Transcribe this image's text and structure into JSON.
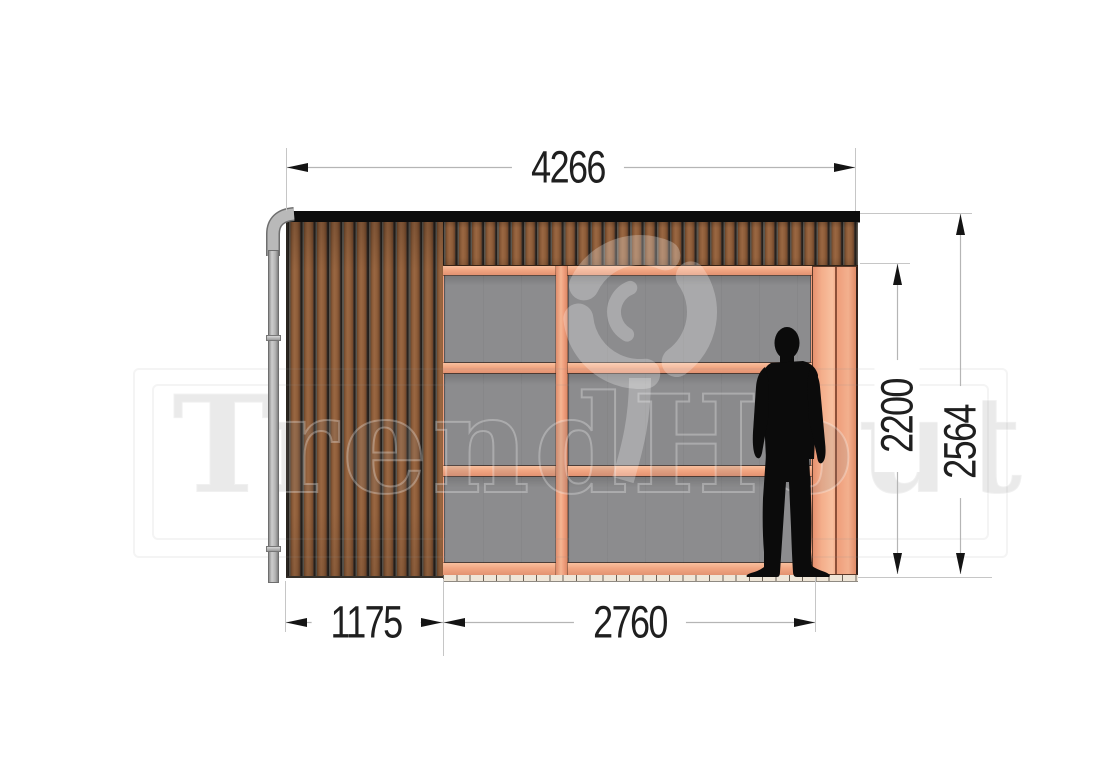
{
  "drawing": {
    "type": "garden-building-front-elevation",
    "dimensions": {
      "total_width_mm": "4266",
      "total_height_mm": "2564",
      "opening_height_mm": "2200",
      "left_section_width_mm": "1175",
      "opening_width_mm": "2760"
    },
    "watermark": {
      "brand": "TrendHout"
    },
    "colors": {
      "frame_wood": "#f0a17e",
      "cladding_wood": "#8a5a37",
      "glass": "#8c8c8e",
      "roof_edge": "#0c0c0c",
      "downpipe": "#b9b9b9",
      "dimension_text": "#1f1f1f",
      "dimension_line": "#b9b9b9"
    }
  }
}
